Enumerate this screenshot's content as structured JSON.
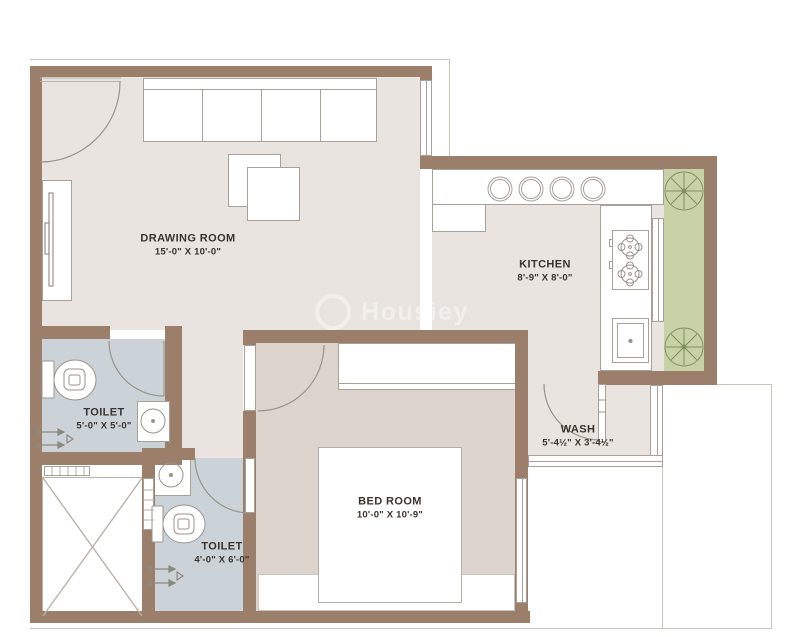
{
  "rooms": [
    {
      "name": "DRAWING ROOM",
      "dims": "15'-0\" X 10'-0\""
    },
    {
      "name": "KITCHEN",
      "dims": "8'-9\" X 8'-0\""
    },
    {
      "name": "TOILET",
      "dims": "5'-0\" X 5'-0\""
    },
    {
      "name": "TOILET",
      "dims": "4'-0\" X 6'-0\""
    },
    {
      "name": "BED ROOM",
      "dims": "10'-0\" X 10'-9\""
    },
    {
      "name": "WASH",
      "dims": "5'-4½\" X 3'-4½\""
    }
  ],
  "watermark": {
    "text": "Housiey"
  },
  "colors": {
    "wall": "#9b7f6b",
    "floor": "#e9e4df",
    "bedroom-floor": "#dcd4cd",
    "toilet-floor": "#cbd2d8",
    "planter": "#c9d2a7",
    "tree": "#7e905c",
    "line": "#a8a19a",
    "thin-line": "#cac4bc",
    "text": "#3a332d"
  },
  "fixtures": [
    "entrance-door",
    "sofa",
    "coffee-tables",
    "tv-unit",
    "refrigerator",
    "kitchen-counter",
    "utensil-plates",
    "gas-hob",
    "kitchen-sink",
    "planter-trees",
    "wardrobe",
    "bed",
    "window-seat",
    "wash-basin",
    "toilet-wc",
    "shower-mixer",
    "lift-shaft",
    "windows",
    "door-swings"
  ]
}
